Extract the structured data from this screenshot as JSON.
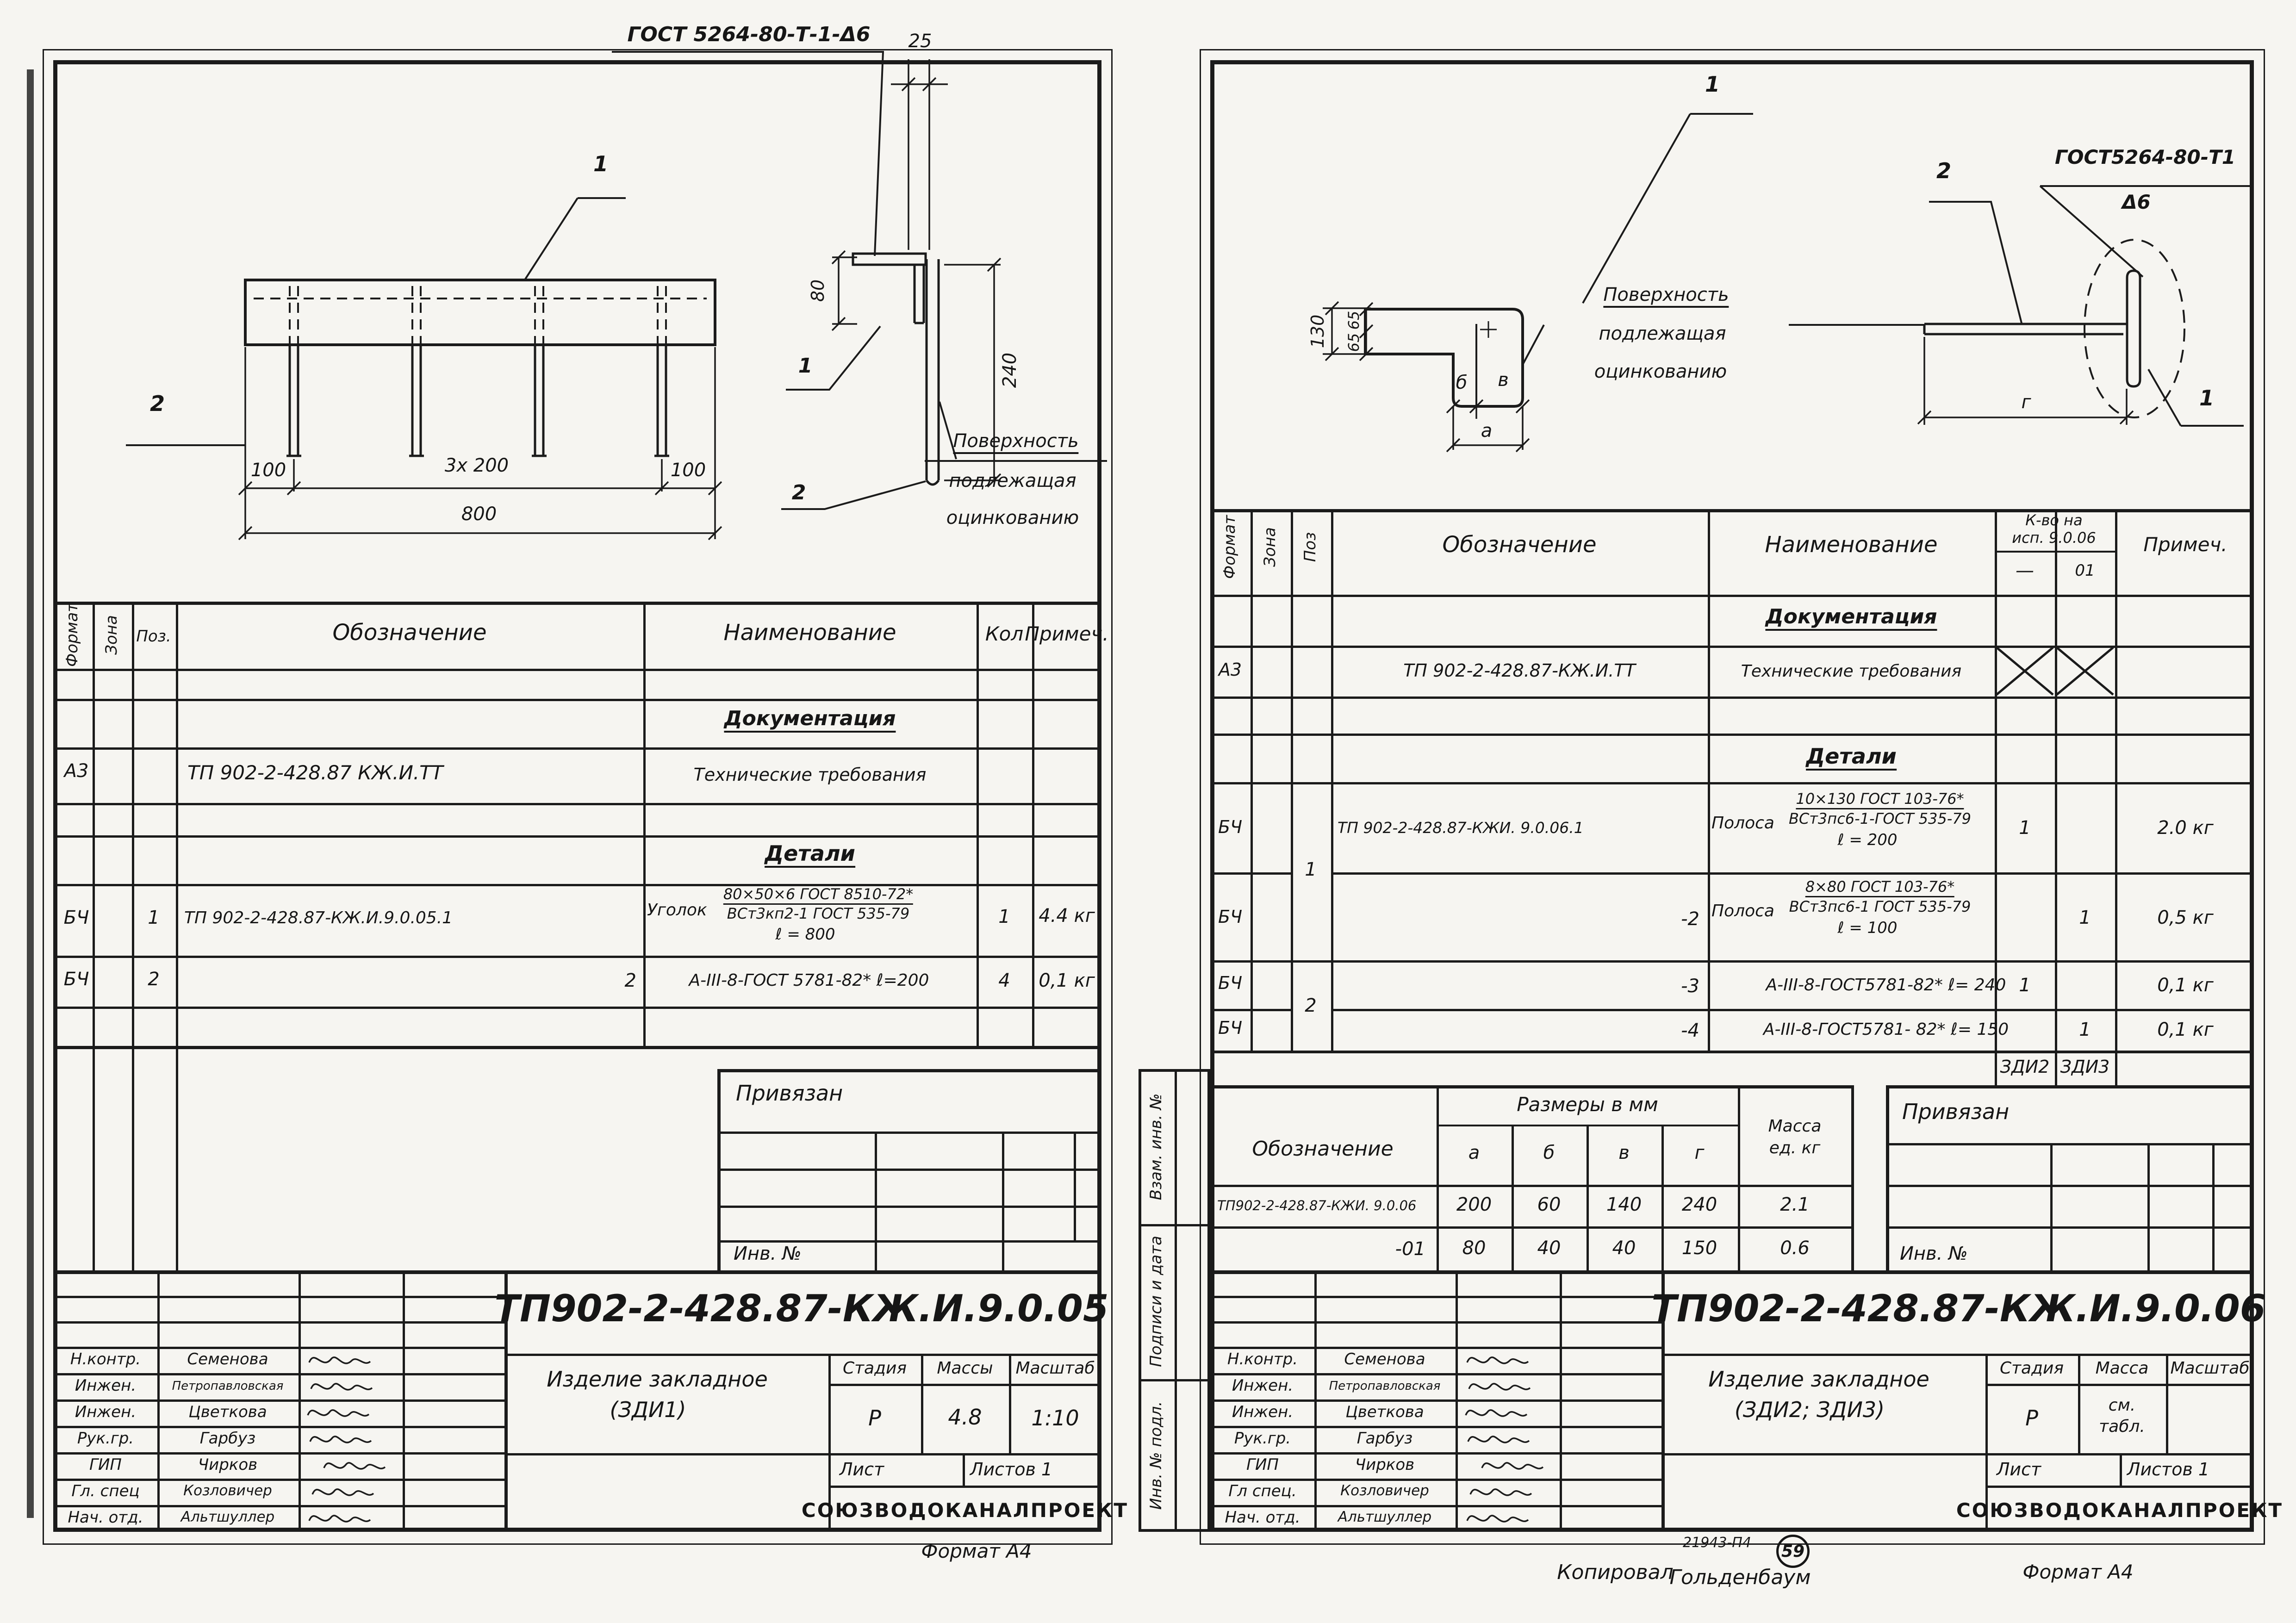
{
  "left": {
    "drawing": {
      "callout": "ГОСТ 5264-80-Т-1-Δ6",
      "pos1": "1",
      "pos2": "2",
      "dim100a": "100",
      "dim200": "3x 200",
      "dim100b": "100",
      "dim800": "800",
      "dim25": "25",
      "dim80": "80",
      "dim240": "240",
      "det1": "1",
      "det2": "2",
      "surf1": "Поверхность",
      "surf2": "подлежащая",
      "surf3": "оцинкованию"
    },
    "spec": {
      "h_format": "Формат",
      "h_zona": "Зона",
      "h_poz": "Поз.",
      "h_oboz": "Обозначение",
      "h_name": "Наименование",
      "h_qty": "Кол",
      "h_note": "Примеч.",
      "sec_doc": "Документация",
      "sec_parts": "Детали",
      "r1_format": "А3",
      "r1_oboz": "ТП 902-2-428.87 КЖ.И.ТТ",
      "r1_name": "Технические требования",
      "r2_format": "БЧ",
      "r2_poz": "1",
      "r2_oboz": "ТП 902-2-428.87-КЖ.И.9.0.05.1",
      "r2_prefix": "Уголок",
      "r2_frac_top": "80×50×6 ГОСТ 8510-72*",
      "r2_frac_bot": "ВСт3кп2-1 ГОСТ 535-79",
      "r2_len": "ℓ = 800",
      "r2_qty": "1",
      "r2_note": "4.4 кг",
      "r3_format": "БЧ",
      "r3_poz": "2",
      "r3_oboz": "2",
      "r3_name": "А-III-8-ГОСТ 5781-82* ℓ=200",
      "r3_qty": "4",
      "r3_note": "0,1 кг"
    },
    "priv": {
      "title": "Привязан",
      "inv": "Инв. №"
    },
    "tb": {
      "doc_no": "ТП902-2-428.87-КЖ.И.9.0.05",
      "title1": "Изделие закладное",
      "title2": "(ЗДИ1)",
      "h_stage": "Стадия",
      "h_mass": "Массы",
      "h_scale": "Масштаб",
      "stage": "Р",
      "mass": "4.8",
      "scale": "1:10",
      "h_sheet": "Лист",
      "h_sheets": "Листов 1",
      "org": "СОЮЗВОДОКАНАЛПРОЕКТ",
      "s1r": "Н.контр.",
      "s1n": "Семенова",
      "s2r": "Инжен.",
      "s2n": "Петропавловская",
      "s3r": "Инжен.",
      "s3n": "Цветкова",
      "s4r": "Рук.гр.",
      "s4n": "Гарбуз",
      "s5r": "ГИП",
      "s5n": "Чирков",
      "s6r": "Гл. спец",
      "s6n": "Козловичер",
      "s7r": "Нач. отд.",
      "s7n": "Альтшуллер"
    },
    "format_note": "Формат А4"
  },
  "right": {
    "drawing": {
      "pos1": "1",
      "dim130": "130",
      "dim65a": "65",
      "dim65b": "65",
      "dim_b": "б",
      "dim_v": "в",
      "dim_a": "а",
      "dim_g": "г",
      "surf1": "Поверхность",
      "surf2": "подлежащая",
      "surf3": "оцинкованию",
      "det2": "2",
      "det1": "1",
      "callout1": "ГОСТ5264-80-Т1",
      "callout2": "Δ6"
    },
    "spec": {
      "h_format": "Формат",
      "h_zona": "Зона",
      "h_poz": "Поз",
      "h_oboz": "Обозначение",
      "h_name": "Наименование",
      "h_qty1": "К-во на",
      "h_qty2": "исп. 9.0.06",
      "h_sub1": "—",
      "h_sub2": "01",
      "h_note": "Примеч.",
      "sec_doc": "Документация",
      "sec_parts": "Детали",
      "r1_format": "А3",
      "r1_oboz": "ТП 902-2-428.87-КЖ.И.ТТ",
      "r1_name": "Технические требования",
      "poz1": "1",
      "poz2": "2",
      "r2_format": "БЧ",
      "r2_oboz": "ТП 902-2-428.87-КЖИ. 9.0.06.1",
      "r2_prefix": "Полоса",
      "r2_frac_top": "10×130 ГОСТ 103-76*",
      "r2_frac_bot": "ВСт3пс6-1-ГОСТ 535-79",
      "r2_len": "ℓ = 200",
      "r2_qty": "1",
      "r2_note": "2.0 кг",
      "r3_format": "БЧ",
      "r3_oboz": "-2",
      "r3_prefix": "Полоса",
      "r3_frac_top": "8×80 ГОСТ 103-76*",
      "r3_frac_bot": "ВСт3пс6-1 ГОСТ 535-79",
      "r3_len": "ℓ = 100",
      "r3_qty": "1",
      "r3_note": "0,5 кг",
      "r4_format": "БЧ",
      "r4_oboz": "-3",
      "r4_name": "А-III-8-ГОСТ5781-82* ℓ= 240",
      "r4_qty": "1",
      "r4_note": "0,1 кг",
      "r5_format": "БЧ",
      "r5_oboz": "-4",
      "r5_name": "А-III-8-ГОСТ5781- 82* ℓ= 150",
      "r5_qty": "1",
      "r5_note": "0,1 кг",
      "tag1": "ЗДИ2",
      "tag2": "ЗДИ3"
    },
    "sizes": {
      "h_oboz": "Обозначение",
      "h_sizes": "Размеры в мм",
      "h_a": "а",
      "h_b": "б",
      "h_v": "в",
      "h_g": "г",
      "h_mass1": "Масса",
      "h_mass2": "ед. кг",
      "r1_oboz": "ТП902-2-428.87-КЖИ. 9.0.06",
      "r1_a": "200",
      "r1_b": "60",
      "r1_v": "140",
      "r1_g": "240",
      "r1_m": "2.1",
      "r2_oboz": "-01",
      "r2_a": "80",
      "r2_b": "40",
      "r2_v": "40",
      "r2_g": "150",
      "r2_m": "0.6"
    },
    "priv": {
      "title": "Привязан",
      "inv": "Инв. №"
    },
    "strip": {
      "c1": "Взам. инв. №",
      "c2": "Подписи и дата",
      "c3": "Инв. № подл."
    },
    "tb": {
      "doc_no": "ТП902-2-428.87-КЖ.И.9.0.06",
      "title1": "Изделие закладное",
      "title2": "(ЗДИ2; ЗДИ3)",
      "h_stage": "Стадия",
      "h_mass": "Масса",
      "h_scale": "Масштаб",
      "stage": "Р",
      "mass1": "см.",
      "mass2": "табл.",
      "scale": "",
      "h_sheet": "Лист",
      "h_sheets": "Листов 1",
      "org": "СОЮЗВОДОКАНАЛПРОЕКТ",
      "s1r": "Н.контр.",
      "s1n": "Семенова",
      "s2r": "Инжен.",
      "s2n": "Петропавловская",
      "s3r": "Инжен.",
      "s3n": "Цветкова",
      "s4r": "Рук.гр.",
      "s4n": "Гарбуз",
      "s5r": "ГИП",
      "s5n": "Чирков",
      "s6r": "Гл спец.",
      "s6n": "Козловичер",
      "s7r": "Нач. отд.",
      "s7n": "Альтшуллер"
    },
    "stamp": "21943-П4",
    "stamp_no": "59",
    "copy_note": "Копировал",
    "copy_name": "Гольденбаум",
    "format_note": "Формат А4"
  }
}
